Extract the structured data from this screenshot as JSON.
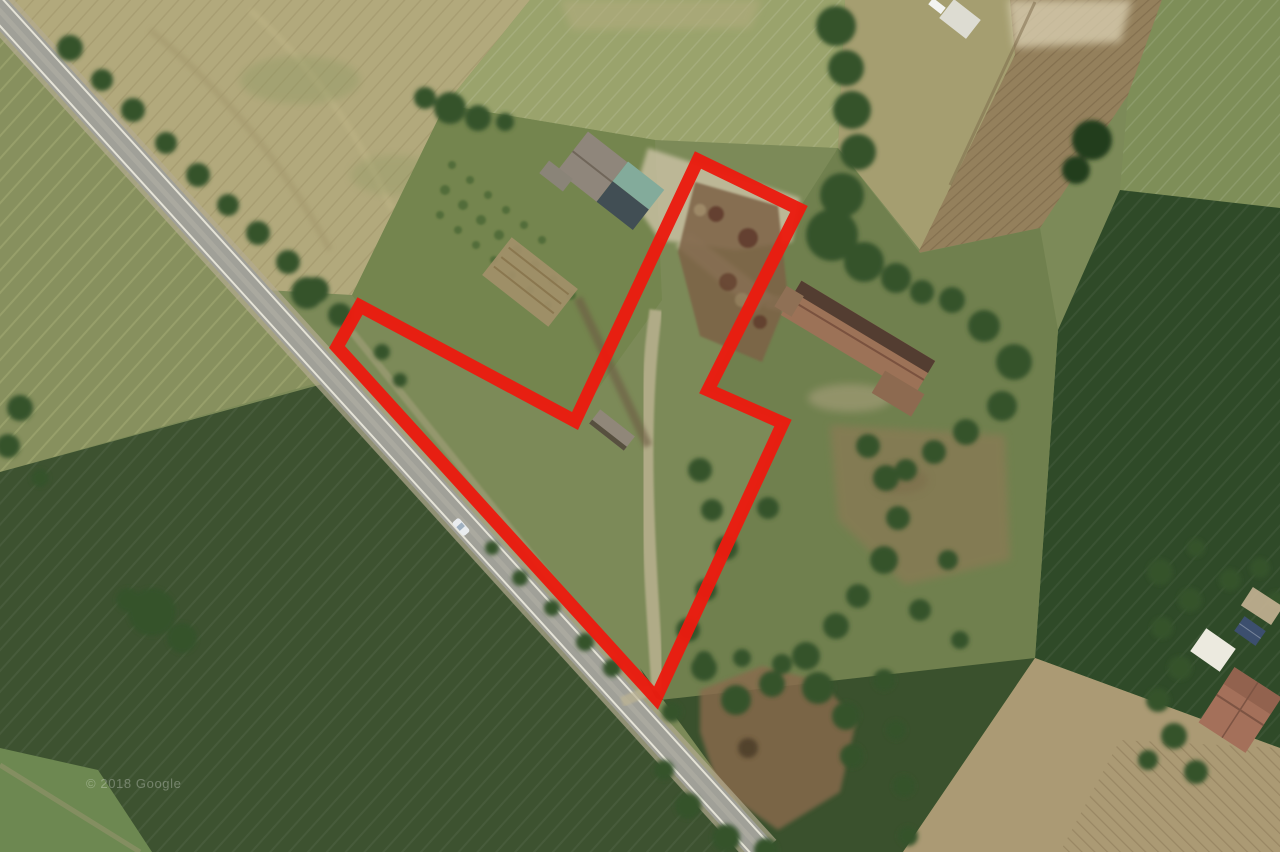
{
  "scene": {
    "type": "satellite-aerial-view",
    "description": "Rural farmland aerial photo with a red property-boundary outline, diagonal road, farmhouse and field parcels",
    "boundary": {
      "points": "360,306 575,421 698,160 799,209 708,390 783,423 656,698 337,347",
      "color": "#ea1c10",
      "stroke_width": 13
    },
    "watermark": {
      "text": "© 2018 Google",
      "color": "#ffffff",
      "opacity": 0.28
    },
    "palette": {
      "field_olive": "#87905e",
      "field_dark_green": "#3d5230",
      "field_tan": "#b2a97c",
      "field_brown_plowed": "#94805c",
      "big_dark_crop_field": "#2f4a28",
      "road_gray": "#a0a098",
      "farmhouse_roof": "#9c7257",
      "shed_teal_roof": "#83ab9b"
    }
  }
}
